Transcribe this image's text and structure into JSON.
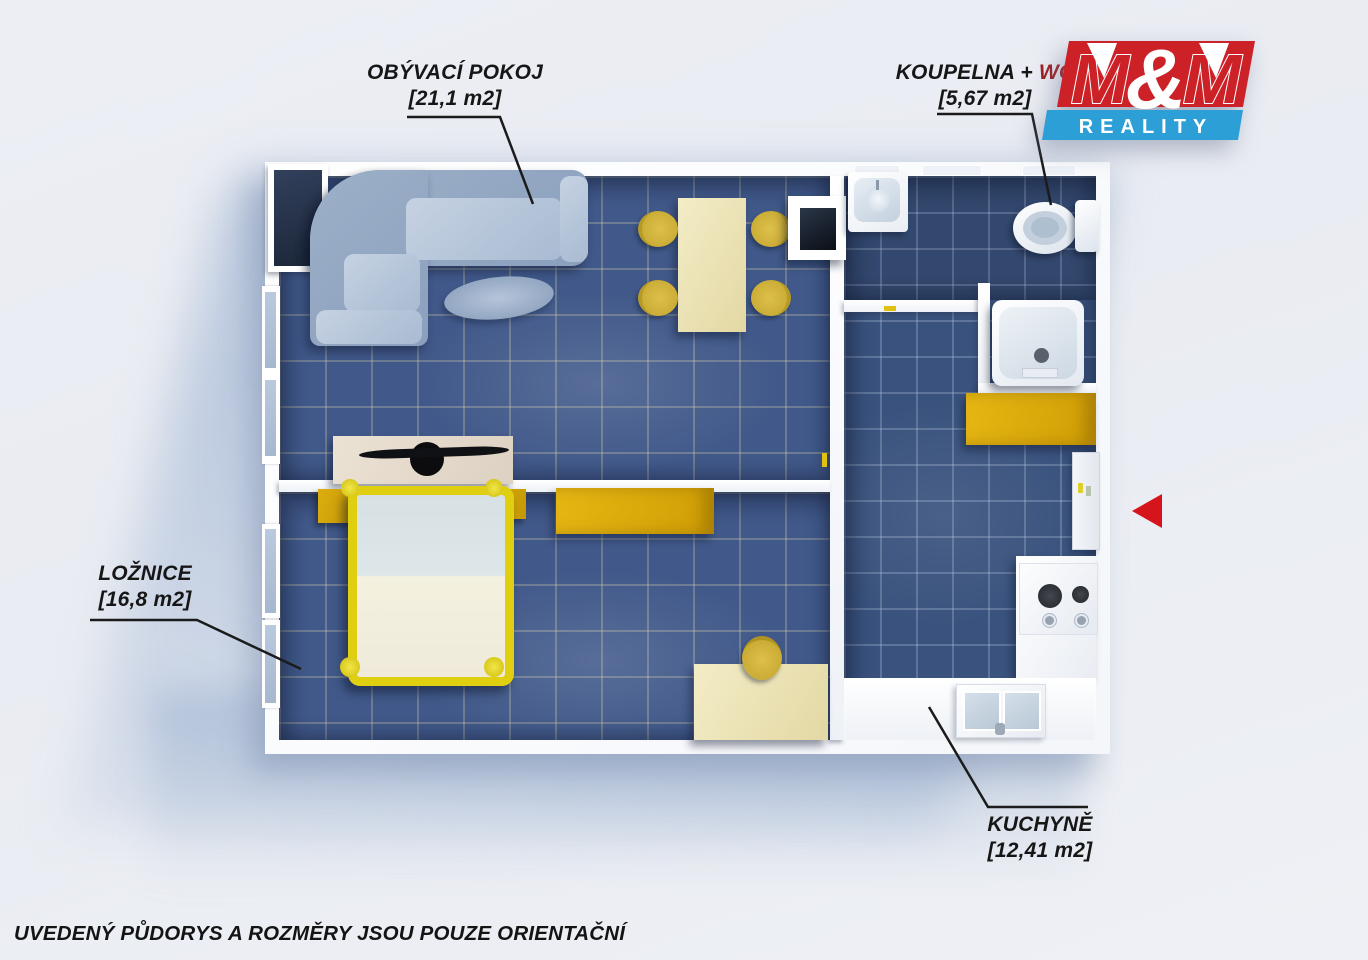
{
  "rooms": {
    "living_room": {
      "label": "OBÝVACÍ POKOJ",
      "area": "[21,1 m2]"
    },
    "bathroom": {
      "label": "KOUPELNA +",
      "label_wc": "WC",
      "area": "[5,67 m2]"
    },
    "bedroom": {
      "label": "LOŽNICE",
      "area": "[16,8 m2]"
    },
    "kitchen": {
      "label": "KUCHYNĚ",
      "area": "[12,41 m2]"
    }
  },
  "logo": {
    "m_left": "M",
    "ampersand": "&",
    "m_right": "M",
    "subtitle": "REALITY",
    "red_hex": "#cb2127",
    "blue_hex": "#2c9fd6"
  },
  "disclaimer": "UVEDENÝ PŮDORYS A ROZMĚRY JSOU POUZE ORIENTAČNÍ",
  "entrance_marker": {
    "type": "arrow-left",
    "color_hex": "#d6141c"
  },
  "palette": {
    "floor_tile_blue": "#41598a",
    "floor_tile_dark_blue": "#33486e",
    "wall_white": "#ffffff",
    "furniture_mustard": "#d7a50e",
    "bed_frame_yellow": "#e0cf10",
    "sofa_gray_blue": "#a7b8d0",
    "table_cream": "#f0e9c2",
    "label_black": "#161616",
    "wc_red": "#9e1c20",
    "shadow_blue": "#b7c6dd"
  }
}
